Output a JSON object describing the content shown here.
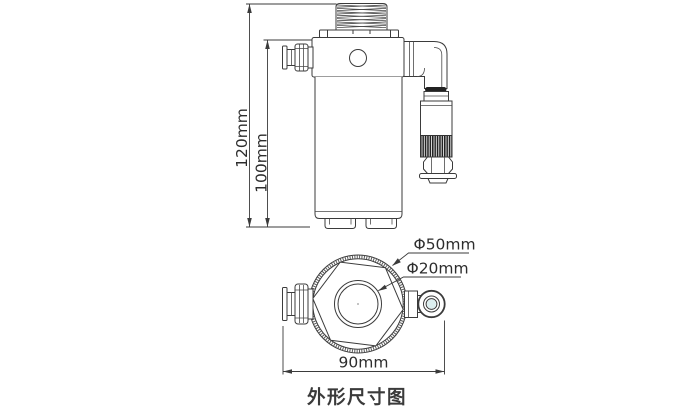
{
  "drawing": {
    "caption": "外形尺寸图",
    "front_view": {
      "overall_height": "120mm",
      "body_height": "100mm"
    },
    "top_view": {
      "outer_diameter": "Φ50mm",
      "port_diameter": "Φ20mm",
      "overall_width": "90mm"
    },
    "colors": {
      "line": "#3b3b3b",
      "text": "#2d2d2d",
      "knurl_dark": "#222222",
      "eyelet_center": "#ddeff0",
      "background": "#ffffff"
    }
  }
}
